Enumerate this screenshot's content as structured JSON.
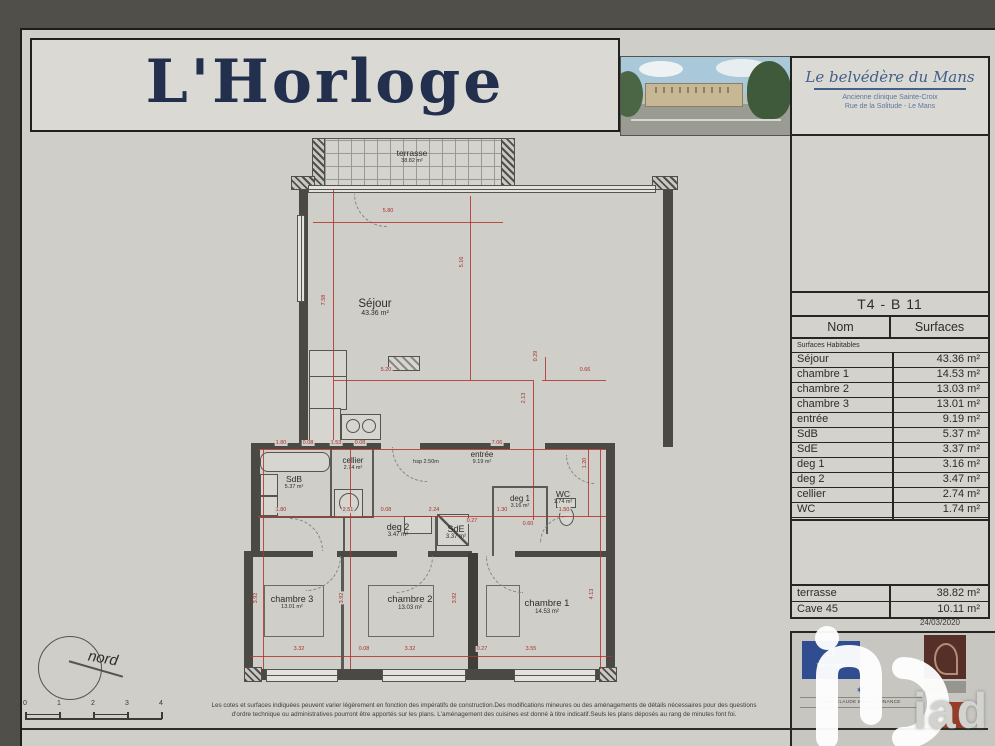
{
  "header": {
    "logo": "L'Horloge",
    "residence": {
      "name": "Le belvédère du Mans",
      "line1": "Ancienne clinique Sainte-Croix",
      "line2": "Rue de la Solitude - Le Mans"
    }
  },
  "sidebar": {
    "floor_label": "premier étage",
    "unit_label": "T4 - B 11",
    "surfaces": {
      "col_name": "Nom",
      "col_value": "Surfaces",
      "subheader": "Surfaces Habitables",
      "rows": [
        {
          "name": "Séjour",
          "value": "43.36 m²"
        },
        {
          "name": "chambre 1",
          "value": "14.53 m²"
        },
        {
          "name": "chambre 2",
          "value": "13.03 m²"
        },
        {
          "name": "chambre 3",
          "value": "13.01 m²"
        },
        {
          "name": "entrée",
          "value": "9.19 m²"
        },
        {
          "name": "SdB",
          "value": "5.37 m²"
        },
        {
          "name": "SdE",
          "value": "3.37 m²"
        },
        {
          "name": "deg 1",
          "value": "3.16 m²"
        },
        {
          "name": "deg 2",
          "value": "3.47 m²"
        },
        {
          "name": "cellier",
          "value": "2.74 m²"
        },
        {
          "name": "WC",
          "value": "1.74 m²"
        }
      ],
      "total": {
        "name": "Total général",
        "value": "112.97 m²"
      }
    },
    "annex_rows": [
      {
        "name": "terrasse",
        "value": "38.82 m²"
      },
      {
        "name": "Cave 45",
        "value": "10.11 m²"
      }
    ],
    "date": "24/03/2020",
    "logos": {
      "promoter": "Yes Wimmo",
      "promoter_icon": "⌂",
      "broker_star": "✶",
      "broker": "JEAN CLAUDE BIGANT FINANCE",
      "watermark": "iad"
    }
  },
  "plan": {
    "rooms": {
      "terrasse": {
        "name": "terrasse",
        "area": "38.82 m²"
      },
      "sejour": {
        "name": "Séjour",
        "area": "43.36 m²"
      },
      "sdb": {
        "name": "SdB",
        "area": "5.37 m²"
      },
      "cellier": {
        "name": "cellier",
        "area": "2.74 m²"
      },
      "entree": {
        "name": "entrée",
        "area": "9.19 m²"
      },
      "hsp_note": "hsp 2.50m",
      "deg1": {
        "name": "deg 1",
        "area": "3.16 m²"
      },
      "wc": {
        "name": "WC",
        "area": "1.74 m²"
      },
      "deg2": {
        "name": "deg 2",
        "area": "3.47 m²"
      },
      "sde": {
        "name": "SdE",
        "area": "3.37 m²"
      },
      "chambre3": {
        "name": "chambre 3",
        "area": "13.01 m²"
      },
      "chambre2": {
        "name": "chambre 2",
        "area": "13.03 m²"
      },
      "chambre1": {
        "name": "chambre 1",
        "area": "14.53 m²"
      }
    },
    "dimensions": [
      {
        "id": "d580",
        "text": "5.80"
      },
      {
        "id": "d758",
        "text": "7.58"
      },
      {
        "id": "d516",
        "text": "5.16"
      },
      {
        "id": "d520",
        "text": "5.20"
      },
      {
        "id": "d213",
        "text": "2.13"
      },
      {
        "id": "d066",
        "text": "0.66"
      },
      {
        "id": "d029",
        "text": "0.29"
      },
      {
        "id": "m180a",
        "text": "1.80"
      },
      {
        "id": "m008a",
        "text": "0.08"
      },
      {
        "id": "m153",
        "text": "1.53"
      },
      {
        "id": "m008b",
        "text": "0.08"
      },
      {
        "id": "m706",
        "text": "7.06"
      },
      {
        "id": "m180b",
        "text": "1.80"
      },
      {
        "id": "m251",
        "text": "2.51"
      },
      {
        "id": "m008c",
        "text": "0.08"
      },
      {
        "id": "m224",
        "text": "2.24"
      },
      {
        "id": "m130",
        "text": "1.30"
      },
      {
        "id": "m150",
        "text": "1.50"
      },
      {
        "id": "m027a",
        "text": "0.27"
      },
      {
        "id": "m060",
        "text": "0.60"
      },
      {
        "id": "d120",
        "text": "1.20"
      },
      {
        "id": "b332a",
        "text": "3.32"
      },
      {
        "id": "b008",
        "text": "0.08"
      },
      {
        "id": "b332b",
        "text": "3.32"
      },
      {
        "id": "b027",
        "text": "0.27"
      },
      {
        "id": "b355",
        "text": "3.55"
      },
      {
        "id": "v392a",
        "text": "3.92"
      },
      {
        "id": "v392b",
        "text": "3.92"
      },
      {
        "id": "v392c",
        "text": "3.92"
      },
      {
        "id": "v413",
        "text": "4.13"
      }
    ],
    "compass_label": "nord",
    "scale_ticks": [
      "0",
      "1",
      "2",
      "3",
      "4"
    ]
  },
  "footer": {
    "disclaimer1": "Les cotes et surfaces indiquées peuvent varier légèrement en fonction des impératifs de construction.Des modifications mineures ou des aménagements de détails nécessaires pour des questions",
    "disclaimer2": "d'ordre technique ou administratives pourront être apportés sur les plans. L'aménagement des cuisines est donné à titre indicatif.Seuls les plans déposés au rang de minutes font foi."
  },
  "colors": {
    "dimension_red": "#b5342e",
    "logo_navy": "#22304e",
    "promoter_blue": "#2f4d8f",
    "keyplan_highlight": "#c0392b"
  }
}
